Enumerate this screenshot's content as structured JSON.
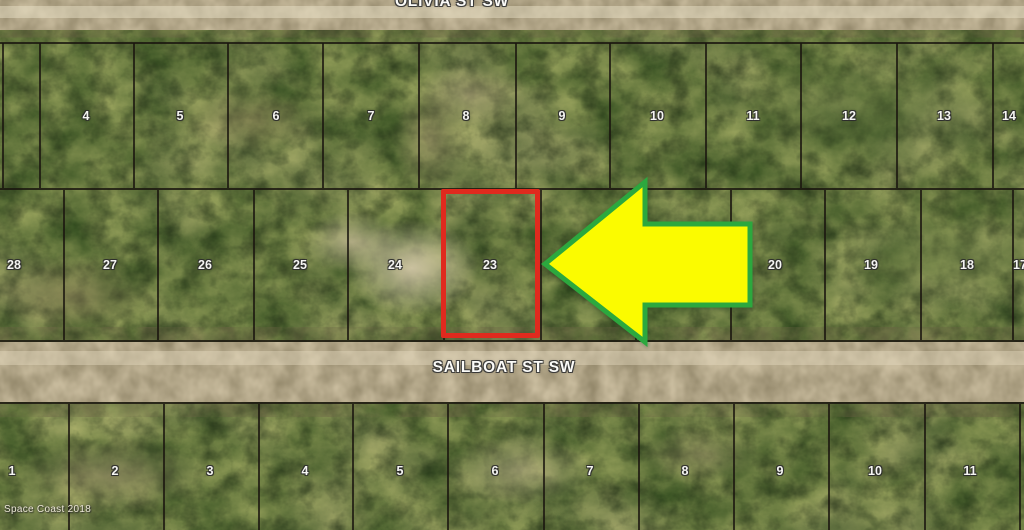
{
  "map": {
    "watermark": "Space Coast 2018",
    "streets": [
      {
        "name": "OLIVIA ST SW"
      },
      {
        "name": "SAILBOAT ST SW"
      }
    ],
    "highlighted_lot": "23",
    "rows": {
      "north": {
        "lines": [
          {
            "x": 2
          },
          {
            "x": 39
          },
          {
            "x": 133
          },
          {
            "x": 227
          },
          {
            "x": 322
          },
          {
            "x": 418
          },
          {
            "x": 515
          },
          {
            "x": 609
          },
          {
            "x": 705
          },
          {
            "x": 800
          },
          {
            "x": 896
          },
          {
            "x": 992
          }
        ],
        "lots": [
          {
            "label": "4",
            "x": 86
          },
          {
            "label": "5",
            "x": 180
          },
          {
            "label": "6",
            "x": 276
          },
          {
            "label": "7",
            "x": 371
          },
          {
            "label": "8",
            "x": 466
          },
          {
            "label": "9",
            "x": 562
          },
          {
            "label": "10",
            "x": 657
          },
          {
            "label": "11",
            "x": 753
          },
          {
            "label": "12",
            "x": 849
          },
          {
            "label": "13",
            "x": 944
          },
          {
            "label": "14",
            "x": 1009
          }
        ]
      },
      "middle": {
        "lines": [
          {
            "x": 63
          },
          {
            "x": 157
          },
          {
            "x": 253
          },
          {
            "x": 347
          },
          {
            "x": 443
          },
          {
            "x": 540
          },
          {
            "x": 635
          },
          {
            "x": 730
          },
          {
            "x": 824
          },
          {
            "x": 920
          },
          {
            "x": 1012
          }
        ],
        "lots": [
          {
            "label": "28",
            "x": 14
          },
          {
            "label": "27",
            "x": 110
          },
          {
            "label": "26",
            "x": 205
          },
          {
            "label": "25",
            "x": 300
          },
          {
            "label": "24",
            "x": 395
          },
          {
            "label": "23",
            "x": 490
          },
          {
            "label": "20",
            "x": 775
          },
          {
            "label": "19",
            "x": 871
          },
          {
            "label": "18",
            "x": 967
          },
          {
            "label": "17",
            "x": 1020
          }
        ]
      },
      "south": {
        "lines": [
          {
            "x": 68
          },
          {
            "x": 163
          },
          {
            "x": 258
          },
          {
            "x": 352
          },
          {
            "x": 447
          },
          {
            "x": 543
          },
          {
            "x": 638
          },
          {
            "x": 733
          },
          {
            "x": 828
          },
          {
            "x": 924
          },
          {
            "x": 1019
          }
        ],
        "lots": [
          {
            "label": "1",
            "x": 12
          },
          {
            "label": "2",
            "x": 115
          },
          {
            "label": "3",
            "x": 210
          },
          {
            "label": "4",
            "x": 305
          },
          {
            "label": "5",
            "x": 400
          },
          {
            "label": "6",
            "x": 495
          },
          {
            "label": "7",
            "x": 590
          },
          {
            "label": "8",
            "x": 685
          },
          {
            "label": "9",
            "x": 780
          },
          {
            "label": "10",
            "x": 875
          },
          {
            "label": "11",
            "x": 970
          }
        ]
      }
    }
  },
  "colors": {
    "highlight": "#e02a1e",
    "arrow-fill": "#fbfb00",
    "arrow-stroke": "#2ca83e",
    "road": "#c9bc9e",
    "line": "#1a150f"
  }
}
